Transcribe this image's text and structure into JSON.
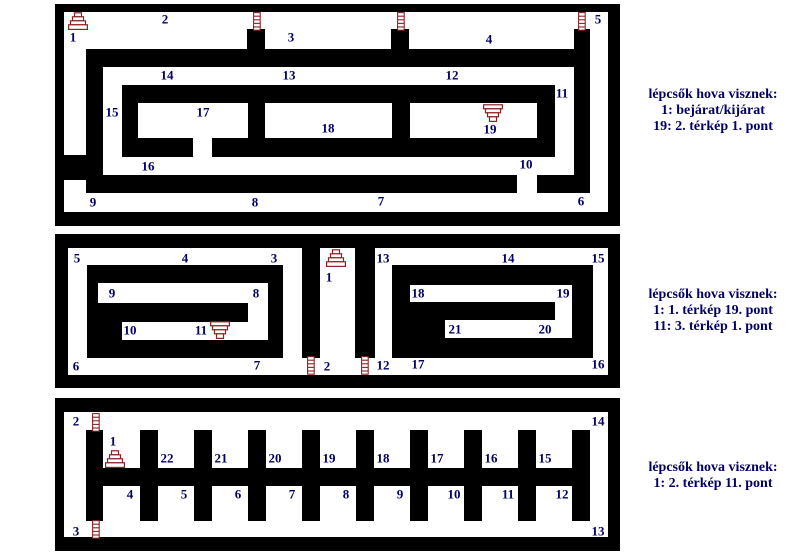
{
  "colors": {
    "wall": "#000000",
    "label": "#000066",
    "stairs": "#8b2323",
    "background": "#ffffff"
  },
  "legends": [
    {
      "cx": 713,
      "top": 87,
      "lines": [
        "lépcsők hova visznek:",
        "1: bejárat/kijárat",
        "19: 2. térkép 1. pont"
      ]
    },
    {
      "cx": 713,
      "top": 287,
      "lines": [
        "lépcsők hova visznek:",
        "1: 1. térkép 19. pont",
        "11: 3. térkép 1. pont"
      ]
    },
    {
      "cx": 713,
      "top": 460,
      "lines": [
        "lépcsők hova visznek:",
        "1: 2. térkép 11. pont"
      ]
    }
  ],
  "panels": [
    {
      "name": "map-1",
      "walls": [
        [
          55,
          4,
          565,
          8
        ],
        [
          55,
          212,
          565,
          14
        ],
        [
          55,
          4,
          9,
          222
        ],
        [
          608,
          4,
          12,
          222
        ],
        [
          86,
          49,
          504,
          18
        ],
        [
          86,
          49,
          17,
          144
        ],
        [
          86,
          175,
          431,
          18
        ],
        [
          537,
          175,
          53,
          18
        ],
        [
          574,
          29,
          16,
          164
        ],
        [
          247,
          29,
          18,
          20
        ],
        [
          391,
          29,
          18,
          20
        ],
        [
          55,
          155,
          31,
          25
        ],
        [
          122,
          85,
          433,
          18
        ],
        [
          122,
          85,
          16,
          72
        ],
        [
          537,
          85,
          18,
          72
        ],
        [
          122,
          138,
          71,
          19
        ],
        [
          212,
          138,
          343,
          19
        ],
        [
          248,
          103,
          17,
          35
        ],
        [
          392,
          103,
          18,
          35
        ]
      ],
      "labels": [
        [
          "1",
          73,
          37
        ],
        [
          "2",
          165,
          19
        ],
        [
          "3",
          291,
          37
        ],
        [
          "4",
          489,
          39
        ],
        [
          "5",
          598,
          19
        ],
        [
          "14",
          167,
          75
        ],
        [
          "13",
          289,
          75
        ],
        [
          "12",
          452,
          75
        ],
        [
          "11",
          562,
          93
        ],
        [
          "15",
          112,
          112
        ],
        [
          "17",
          203,
          112
        ],
        [
          "18",
          328,
          128
        ],
        [
          "19",
          490,
          129
        ],
        [
          "16",
          148,
          166
        ],
        [
          "10",
          526,
          164
        ],
        [
          "9",
          93,
          202
        ],
        [
          "8",
          255,
          202
        ],
        [
          "7",
          381,
          201
        ],
        [
          "6",
          581,
          201
        ]
      ],
      "icons": [
        [
          "stairs-up",
          68,
          12
        ],
        [
          "ladder",
          253,
          12
        ],
        [
          "ladder",
          397,
          12
        ],
        [
          "ladder",
          578,
          12
        ],
        [
          "stairs-down",
          483,
          104
        ]
      ]
    },
    {
      "name": "map-2",
      "walls": [
        [
          55,
          234,
          565,
          14
        ],
        [
          55,
          375,
          565,
          13
        ],
        [
          55,
          234,
          13,
          154
        ],
        [
          608,
          234,
          12,
          154
        ],
        [
          87,
          265,
          196,
          18
        ],
        [
          87,
          283,
          11,
          75
        ],
        [
          268,
          283,
          15,
          75
        ],
        [
          87,
          340,
          196,
          18
        ],
        [
          98,
          303,
          150,
          19
        ],
        [
          98,
          322,
          24,
          18
        ],
        [
          392,
          265,
          201,
          20
        ],
        [
          392,
          285,
          18,
          73
        ],
        [
          572,
          285,
          21,
          73
        ],
        [
          392,
          338,
          201,
          20
        ],
        [
          410,
          302,
          145,
          18
        ],
        [
          410,
          320,
          35,
          18
        ],
        [
          302,
          248,
          18,
          110
        ],
        [
          355,
          248,
          20,
          110
        ]
      ],
      "labels": [
        [
          "5",
          77,
          258
        ],
        [
          "4",
          185,
          258
        ],
        [
          "3",
          274,
          258
        ],
        [
          "1",
          329,
          277
        ],
        [
          "13",
          383,
          258
        ],
        [
          "14",
          508,
          258
        ],
        [
          "15",
          598,
          258
        ],
        [
          "9",
          112,
          293
        ],
        [
          "8",
          256,
          293
        ],
        [
          "18",
          418,
          293
        ],
        [
          "19",
          563,
          293
        ],
        [
          "10",
          130,
          330
        ],
        [
          "11",
          201,
          330
        ],
        [
          "21",
          455,
          329
        ],
        [
          "20",
          545,
          329
        ],
        [
          "6",
          76,
          366
        ],
        [
          "7",
          257,
          365
        ],
        [
          "2",
          327,
          366
        ],
        [
          "12",
          383,
          365
        ],
        [
          "17",
          418,
          364
        ],
        [
          "16",
          598,
          364
        ]
      ],
      "icons": [
        [
          "stairs-up",
          326,
          249
        ],
        [
          "stairs-down",
          210,
          321
        ],
        [
          "ladder",
          307,
          356
        ],
        [
          "ladder",
          361,
          356
        ]
      ]
    },
    {
      "name": "map-3",
      "walls": [
        [
          55,
          398,
          565,
          14
        ],
        [
          55,
          537,
          565,
          14
        ],
        [
          55,
          398,
          9,
          152
        ],
        [
          608,
          398,
          12,
          152
        ],
        [
          86,
          468,
          504,
          18
        ],
        [
          86,
          430,
          17,
          91
        ],
        [
          140,
          430,
          18,
          38
        ],
        [
          194,
          430,
          18,
          38
        ],
        [
          248,
          430,
          18,
          38
        ],
        [
          302,
          430,
          18,
          38
        ],
        [
          356,
          430,
          18,
          38
        ],
        [
          410,
          430,
          18,
          38
        ],
        [
          464,
          430,
          18,
          38
        ],
        [
          518,
          430,
          18,
          38
        ],
        [
          572,
          430,
          18,
          38
        ],
        [
          140,
          486,
          18,
          35
        ],
        [
          194,
          486,
          18,
          35
        ],
        [
          248,
          486,
          18,
          35
        ],
        [
          302,
          486,
          18,
          35
        ],
        [
          356,
          486,
          18,
          35
        ],
        [
          410,
          486,
          18,
          35
        ],
        [
          464,
          486,
          18,
          35
        ],
        [
          518,
          486,
          18,
          35
        ],
        [
          572,
          486,
          18,
          35
        ]
      ],
      "labels": [
        [
          "2",
          76,
          421
        ],
        [
          "14",
          598,
          421
        ],
        [
          "1",
          113,
          441
        ],
        [
          "22",
          167,
          458
        ],
        [
          "21",
          221,
          458
        ],
        [
          "20",
          275,
          458
        ],
        [
          "19",
          329,
          458
        ],
        [
          "18",
          383,
          458
        ],
        [
          "17",
          437,
          458
        ],
        [
          "16",
          491,
          458
        ],
        [
          "15",
          545,
          458
        ],
        [
          "4",
          130,
          494
        ],
        [
          "5",
          184,
          494
        ],
        [
          "6",
          238,
          494
        ],
        [
          "7",
          292,
          494
        ],
        [
          "8",
          346,
          494
        ],
        [
          "9",
          400,
          494
        ],
        [
          "10",
          454,
          494
        ],
        [
          "11",
          508,
          494
        ],
        [
          "12",
          562,
          494
        ],
        [
          "3",
          76,
          531
        ],
        [
          "13",
          598,
          531
        ]
      ],
      "icons": [
        [
          "ladder",
          92,
          413
        ],
        [
          "stairs-up",
          105,
          450
        ],
        [
          "ladder",
          92,
          520
        ]
      ]
    }
  ]
}
